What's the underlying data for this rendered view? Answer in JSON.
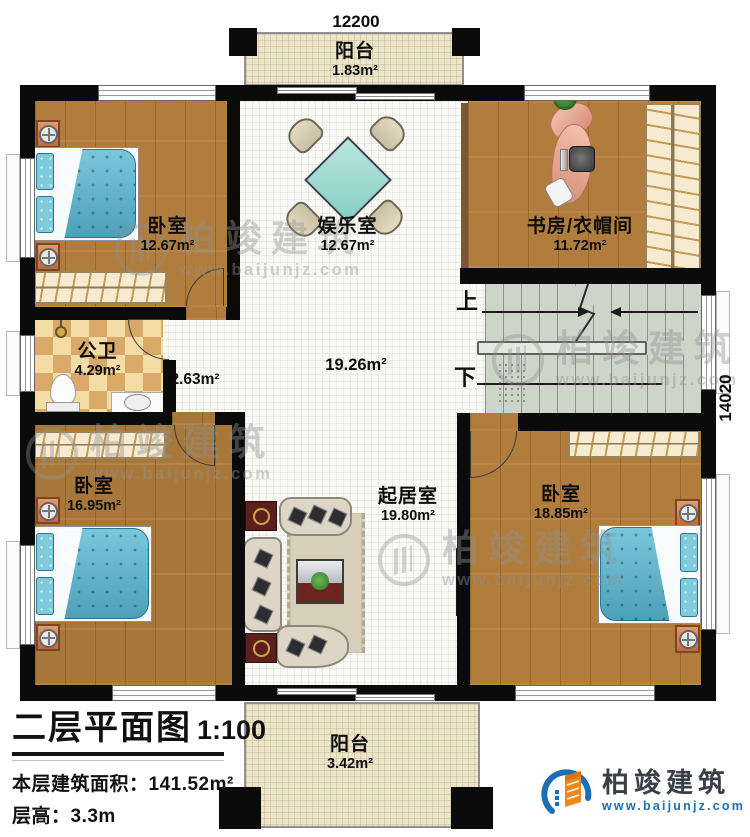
{
  "dimensions": {
    "top": "12200",
    "right": "14020"
  },
  "stairs": {
    "up": "上",
    "down": "下"
  },
  "rooms": {
    "balcony_top": {
      "name": "阳台",
      "area": "1.83m²"
    },
    "bedroom_top_left": {
      "name": "卧室",
      "area": "12.67m²"
    },
    "entertainment_room": {
      "name": "娱乐室",
      "area": "12.67m²"
    },
    "study_cloakroom": {
      "name": "书房/衣帽间",
      "area": "11.72m²"
    },
    "bathroom": {
      "name": "公卫",
      "area": "4.29m²"
    },
    "corridor": {
      "area": "2.63m²"
    },
    "hall": {
      "area": "19.26m²"
    },
    "bedroom_bottom_left": {
      "name": "卧室",
      "area": "16.95m²"
    },
    "living_room": {
      "name": "起居室",
      "area": "19.80m²"
    },
    "bedroom_bottom_right": {
      "name": "卧室",
      "area": "18.85m²"
    },
    "balcony_bottom": {
      "name": "阳台",
      "area": "3.42m²"
    }
  },
  "title_block": {
    "title": "二层平面图",
    "scale": "1:100",
    "floor_area_label": "本层建筑面积：",
    "floor_area_value": "141.52m²",
    "floor_height_label": "层高：",
    "floor_height_value": "3.3m"
  },
  "branding": {
    "company": "柏竣建筑",
    "website": "www.baijunjz.com"
  },
  "watermark": {
    "company": "柏竣建筑",
    "website": "www.baijunjz.com"
  },
  "colors": {
    "wall": "#0b0b0b",
    "wood_floor": "#b07d3c",
    "tile_floor": "#f8f8f5",
    "balcony_floor": "#ece5ca",
    "bathroom_tile": "#d9a967",
    "stair_floor": "#ccd5c7",
    "bed": "#6fc4d9",
    "logo_blue": "#1a6fb5",
    "logo_orange": "#f0871a"
  }
}
